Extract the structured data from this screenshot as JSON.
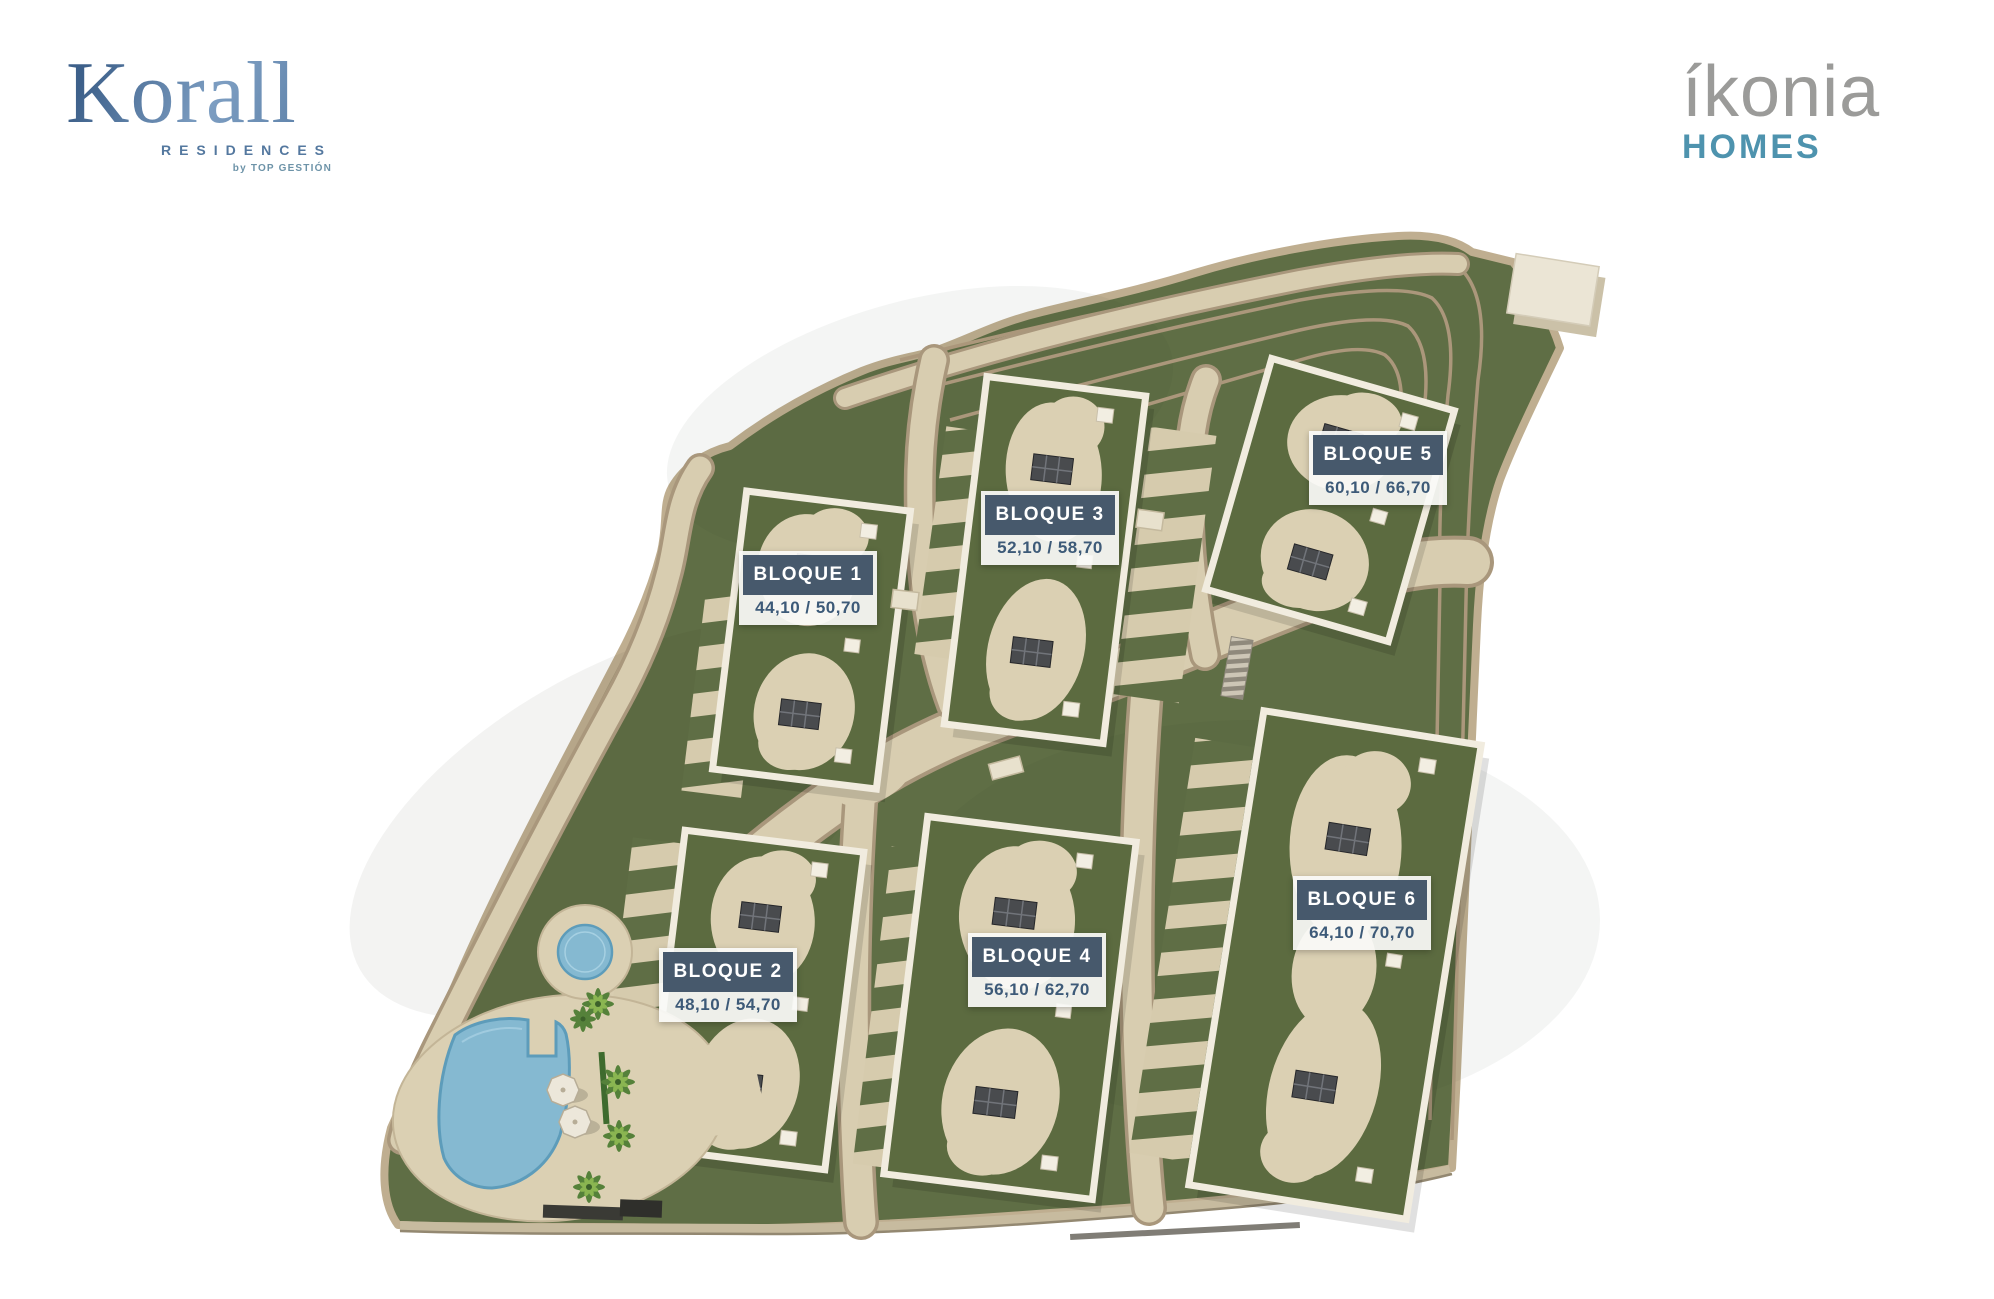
{
  "branding": {
    "korall": {
      "name": "Korall",
      "sub": "RESIDENCES",
      "byline": "by TOP GESTIÓN"
    },
    "ikonia": {
      "name": "íkonia",
      "sub": "HOMES"
    }
  },
  "site_plan": {
    "blocks": [
      {
        "label": "BLOQUE 1",
        "area": "44,10 / 50,70"
      },
      {
        "label": "BLOQUE 2",
        "area": "48,10 / 54,70"
      },
      {
        "label": "BLOQUE 3",
        "area": "52,10 / 58,70"
      },
      {
        "label": "BLOQUE 4",
        "area": "56,10 / 62,70"
      },
      {
        "label": "BLOQUE 5",
        "area": "60,10 / 66,70"
      },
      {
        "label": "BLOQUE 6",
        "area": "64,10 / 70,70"
      }
    ]
  },
  "colors": {
    "label_bg": "#47596c",
    "label_value_text": "#3d5a78",
    "grass": "#5f6e45",
    "path_sand": "#d8cdb0",
    "pool_blue": "#85b9d1",
    "korall_blue": "#54789f",
    "ikonia_gray": "#9b9b99",
    "ikonia_teal": "#4e93ae"
  }
}
